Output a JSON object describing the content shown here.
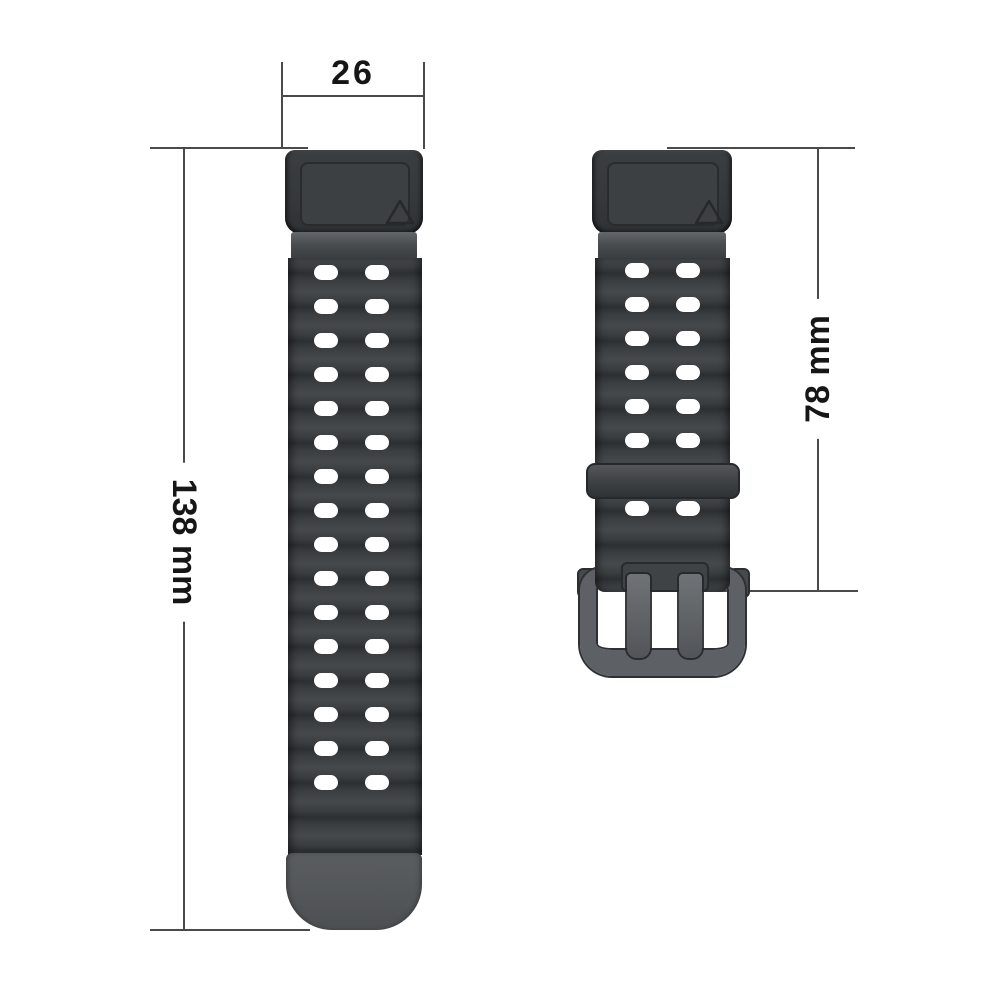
{
  "title": "Watch strap size diagram",
  "dimensions": {
    "width_label": "26",
    "long_strap_length_label": "138 mm",
    "short_strap_length_label": "78 mm"
  },
  "left_strap": {
    "hole_rows": 16,
    "hole_cols": 2
  },
  "right_strap": {
    "hole_rows_above_keeper": 6,
    "hole_rows_below_keeper": 1,
    "hole_cols": 2
  },
  "icons": {
    "connector_mark": "triangle-up-outline"
  },
  "colors": {
    "strap_dark": "#3a3d40",
    "strap_wave_light": "#46494c",
    "strap_wave_dark": "#2c2f32",
    "connector": "#36393c",
    "tip_gray": "#53565a",
    "keeper_gray": "#3d4043",
    "buckle_gray": "#5d6064",
    "hole_white": "#ffffff",
    "dimension_line": "#4a4a4a",
    "label_text": "#161616",
    "background": "#ffffff"
  }
}
